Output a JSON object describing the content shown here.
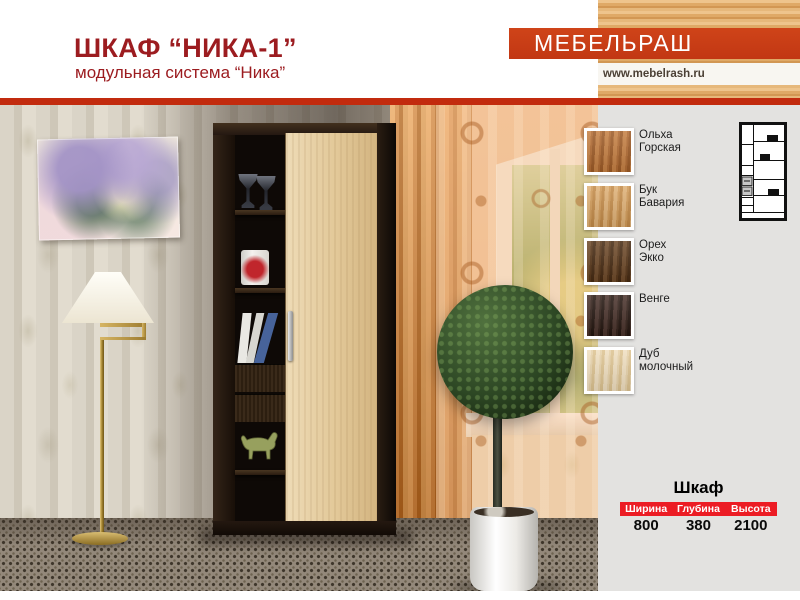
{
  "header": {
    "title": "ШКАФ “НИКА-1”",
    "subtitle": "модульная система “Ника”"
  },
  "brand": {
    "name": "МЕБЕЛЬРАШ",
    "website": "www.mebelrash.ru"
  },
  "colors": {
    "title_text": "#9c1c20",
    "banner_red": "#c93d16",
    "divider_red": "#c22b0e",
    "table_header_red": "#ec1c24",
    "panel_gray": "#e3e2e0"
  },
  "swatches": [
    {
      "label_line1": "Ольха",
      "label_line2": "Горская",
      "color_top": "#c58044",
      "color_mid": "#b06a32",
      "color_bottom": "#9c5a26"
    },
    {
      "label_line1": "Бук",
      "label_line2": "Бавария",
      "color_top": "#dfb177",
      "color_mid": "#d09a58",
      "color_bottom": "#c28a48"
    },
    {
      "label_line1": "Орех",
      "label_line2": "Экко",
      "color_top": "#6e4a2a",
      "color_mid": "#573619",
      "color_bottom": "#462a12"
    },
    {
      "label_line1": "Венге",
      "label_line2": "",
      "color_top": "#4a332c",
      "color_mid": "#34221b",
      "color_bottom": "#241610"
    },
    {
      "label_line1": "Дуб",
      "label_line2": "молочный",
      "color_top": "#f0dfc0",
      "color_mid": "#e7d2aa",
      "color_bottom": "#ddc391"
    }
  ],
  "spec_table": {
    "title": "Шкаф",
    "columns": [
      "Ширина",
      "Глубина",
      "Высота"
    ],
    "values": [
      "800",
      "380",
      "2100"
    ]
  }
}
